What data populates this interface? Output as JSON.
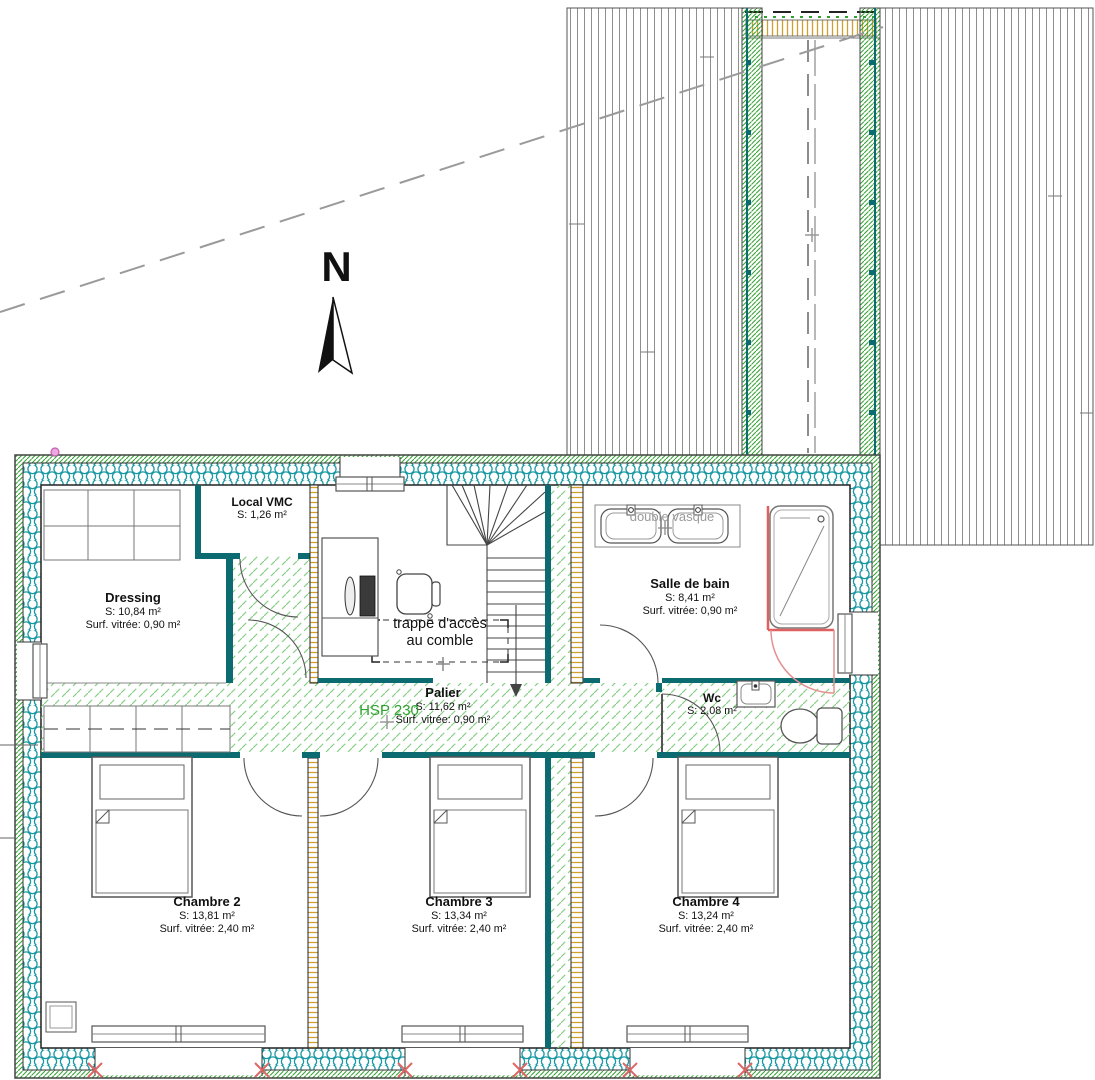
{
  "north": {
    "label": "N"
  },
  "annotations": {
    "hsp": "HSP 230",
    "trappe_line1": "trappe d'accès",
    "trappe_line2": "au comble",
    "double_vasque": "double vasque"
  },
  "rooms": [
    {
      "name": "Local VMC",
      "area": "S: 1,26 m²",
      "glazed": ""
    },
    {
      "name": "Dressing",
      "area": "S: 10,84 m²",
      "glazed": "Surf. vitrée: 0,90 m²"
    },
    {
      "name": "Salle de bain",
      "area": "S: 8,41 m²",
      "glazed": "Surf. vitrée: 0,90 m²"
    },
    {
      "name": "Palier",
      "area": "S: 11,62 m²",
      "glazed": "Surf. vitrée: 0,90 m²"
    },
    {
      "name": "Wc",
      "area": "S: 2,08 m²",
      "glazed": ""
    },
    {
      "name": "Chambre 2",
      "area": "S: 13,81 m²",
      "glazed": "Surf. vitrée: 2,40 m²"
    },
    {
      "name": "Chambre 3",
      "area": "S: 13,34 m²",
      "glazed": "Surf. vitrée: 2,40 m²"
    },
    {
      "name": "Chambre 4",
      "area": "S: 13,24 m²",
      "glazed": "Surf. vitrée: 2,40 m²"
    }
  ],
  "colors": {
    "wall_teal": "#0b6b70",
    "insulation_teal": "#1798a2",
    "hatch_green_dense": "#2fa12f",
    "hatch_green_light": "#86cf86",
    "wood_frame": "#cf9f2f",
    "highlight_red": "#e06060",
    "marker_pink": "#f0a6e0",
    "dashed_gray": "#9a9a9a"
  }
}
